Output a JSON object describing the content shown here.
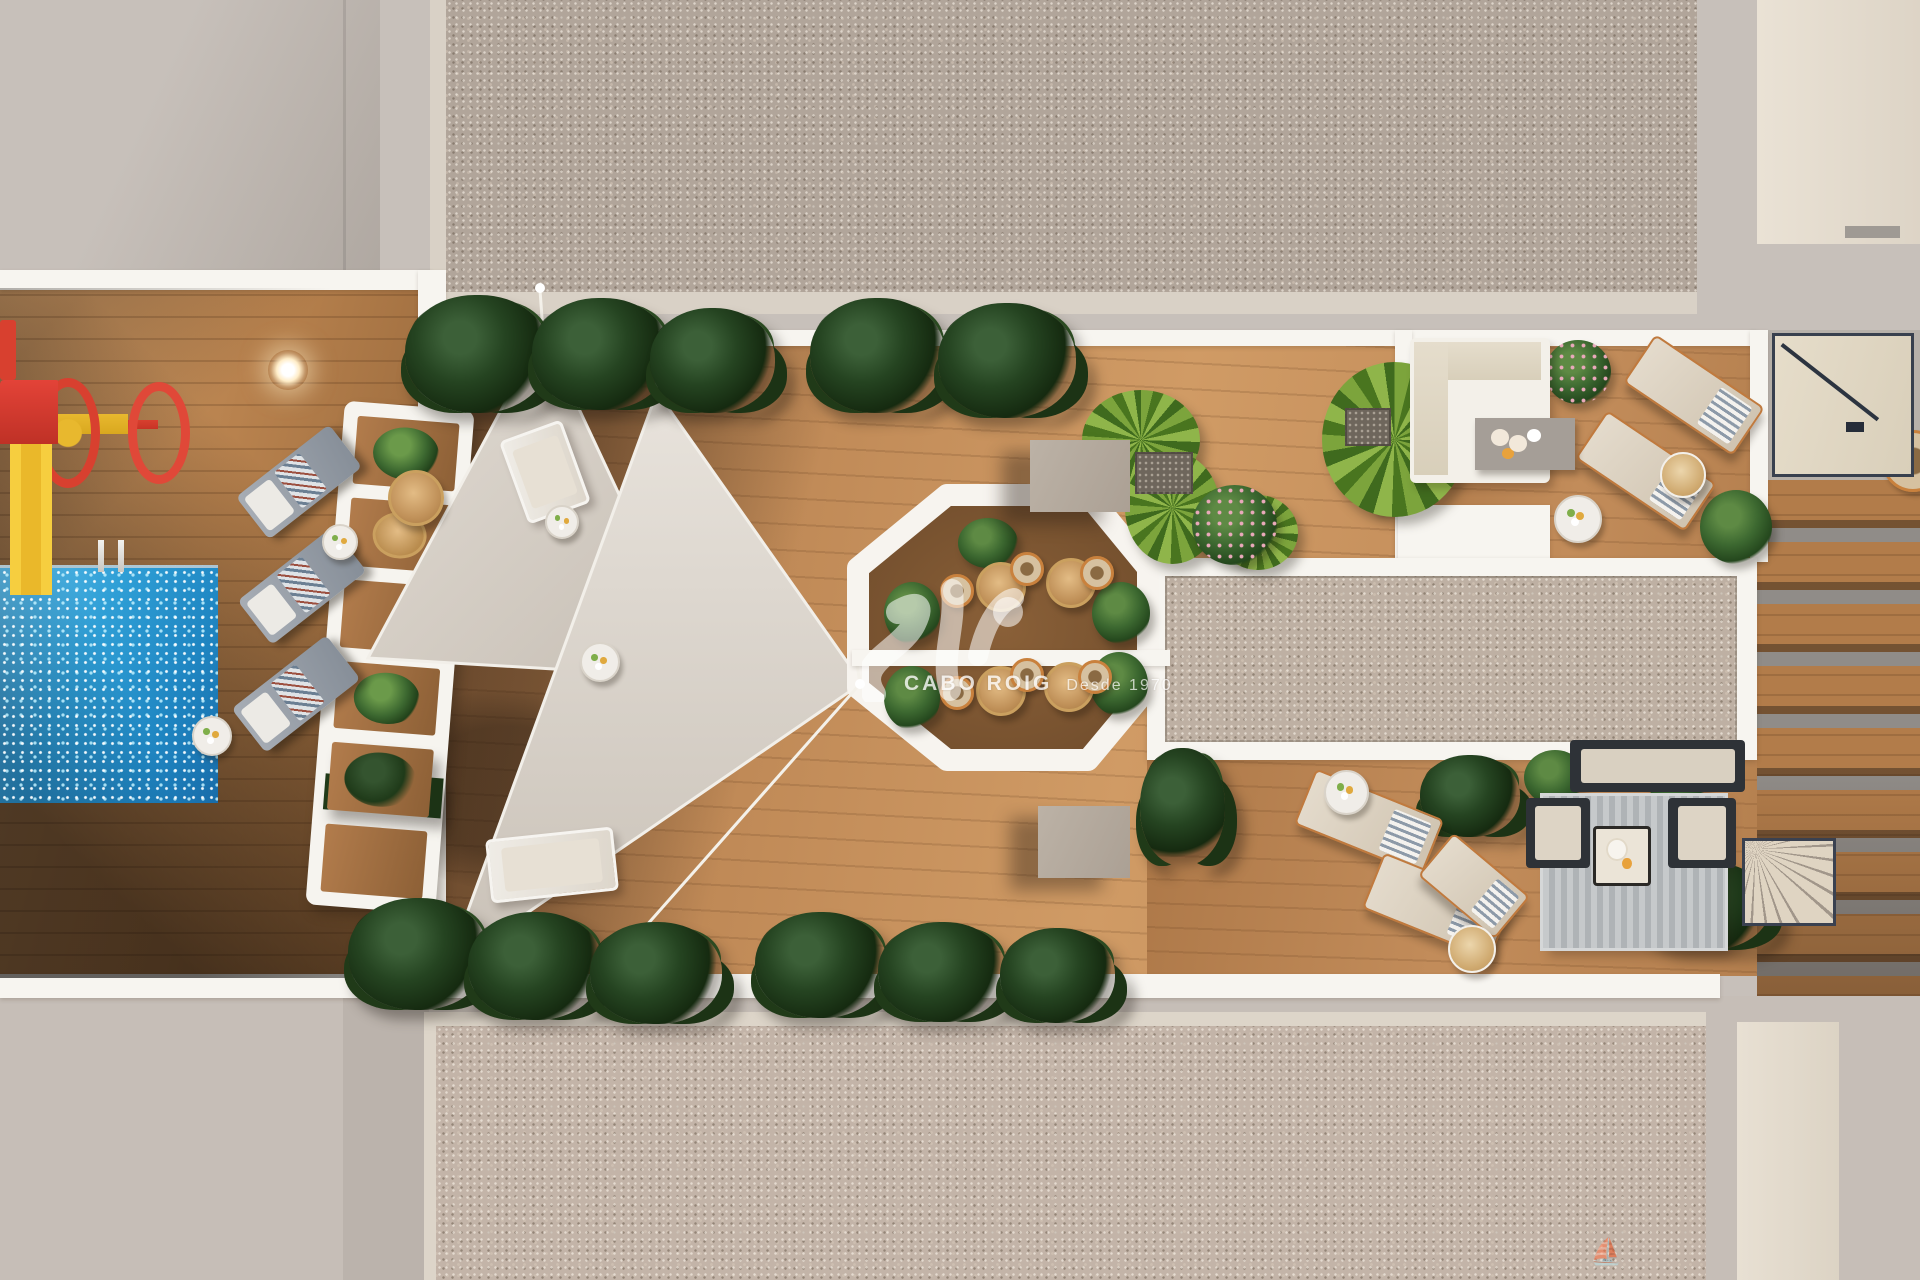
{
  "watermark": {
    "brand": "CABO ROIG",
    "since": "Desde 1970"
  },
  "palette": {
    "pavement": "#c7c0ba",
    "roof_speckle": "#b1a59a",
    "roof_speckle_bottom": "#c3b4a8",
    "carpet_speckle": "#beb0a3",
    "white_border": "#f7f5f0",
    "cream_edge": "#d9d1c6",
    "wood_lit": "#c08a58",
    "wood_shadow": "#8f6136",
    "octagon_wood": "#7d5634",
    "sail": "#d8d1c8",
    "pool_blue": "#2f9fd6",
    "plant_dark": "#254421",
    "plant_bright": "#7ca43c",
    "playground_red": "#d8402f",
    "playground_yellow": "#e8b82e",
    "copper_frame": "#c07a3e",
    "navy_frame": "#38404e",
    "taupe_block": "#b3a99e"
  },
  "scene": {
    "pergola_cells": [
      "plantS",
      "table",
      "wood",
      "plantS",
      "plantD",
      "wood"
    ],
    "items": [
      {
        "t": "plantD",
        "x": 405,
        "y": 295,
        "w": 145,
        "h": 118
      },
      {
        "t": "plantD",
        "x": 532,
        "y": 298,
        "w": 138,
        "h": 112
      },
      {
        "t": "plantD",
        "x": 650,
        "y": 308,
        "w": 125,
        "h": 105
      },
      {
        "t": "plantD",
        "x": 810,
        "y": 298,
        "w": 135,
        "h": 115
      },
      {
        "t": "plantD",
        "x": 938,
        "y": 303,
        "w": 138,
        "h": 115
      },
      {
        "t": "plantD",
        "x": 348,
        "y": 898,
        "w": 140,
        "h": 112
      },
      {
        "t": "plantD",
        "x": 468,
        "y": 912,
        "w": 135,
        "h": 108
      },
      {
        "t": "plantD",
        "x": 590,
        "y": 922,
        "w": 132,
        "h": 102
      },
      {
        "t": "plantD",
        "x": 755,
        "y": 912,
        "w": 132,
        "h": 106
      },
      {
        "t": "plantD",
        "x": 878,
        "y": 922,
        "w": 128,
        "h": 100
      },
      {
        "t": "plantD",
        "x": 1000,
        "y": 928,
        "w": 115,
        "h": 95
      },
      {
        "t": "plantD",
        "x": 1140,
        "y": 748,
        "w": 85,
        "h": 118
      },
      {
        "t": "plantD",
        "x": 1420,
        "y": 755,
        "w": 100,
        "h": 82
      },
      {
        "t": "plantD",
        "x": 1645,
        "y": 862,
        "w": 125,
        "h": 88
      },
      {
        "t": "plantY",
        "x": 1082,
        "y": 390,
        "w": 118,
        "h": 100
      },
      {
        "t": "plantY",
        "x": 1125,
        "y": 452,
        "w": 95,
        "h": 112
      },
      {
        "t": "plantY",
        "x": 1322,
        "y": 362,
        "w": 145,
        "h": 155
      },
      {
        "t": "plantY",
        "x": 1218,
        "y": 495,
        "w": 80,
        "h": 75
      },
      {
        "t": "bushP",
        "x": 1192,
        "y": 485,
        "w": 85,
        "h": 80
      },
      {
        "t": "bushP",
        "x": 1545,
        "y": 340,
        "w": 66,
        "h": 64
      },
      {
        "t": "bushG",
        "x": 1700,
        "y": 490,
        "w": 72,
        "h": 74
      },
      {
        "t": "bushG",
        "x": 958,
        "y": 518,
        "w": 60,
        "h": 50
      },
      {
        "t": "bushG",
        "x": 884,
        "y": 582,
        "w": 56,
        "h": 62
      },
      {
        "t": "bushG",
        "x": 884,
        "y": 666,
        "w": 56,
        "h": 64
      },
      {
        "t": "bushG",
        "x": 1092,
        "y": 582,
        "w": 58,
        "h": 62
      },
      {
        "t": "bushG",
        "x": 1090,
        "y": 652,
        "w": 58,
        "h": 64
      },
      {
        "t": "bushG",
        "x": 1524,
        "y": 750,
        "w": 62,
        "h": 55
      },
      {
        "t": "bushG",
        "x": 1646,
        "y": 750,
        "w": 64,
        "h": 56
      },
      {
        "t": "loungerG",
        "x": 240,
        "y": 455,
        "w": 118,
        "h": 54,
        "r": -38
      },
      {
        "t": "loungerG",
        "x": 242,
        "y": 558,
        "w": 120,
        "h": 56,
        "r": -38
      },
      {
        "t": "loungerG",
        "x": 236,
        "y": 666,
        "w": 120,
        "h": 56,
        "r": -38
      },
      {
        "t": "loungerW",
        "x": 512,
        "y": 428,
        "w": 66,
        "h": 88,
        "r": -20
      },
      {
        "t": "loungerW",
        "x": 488,
        "y": 833,
        "w": 128,
        "h": 64,
        "r": -6
      },
      {
        "t": "loungerB",
        "x": 1628,
        "y": 366,
        "w": 132,
        "h": 58,
        "r": 34
      },
      {
        "t": "loungerB",
        "x": 1580,
        "y": 442,
        "w": 132,
        "h": 58,
        "r": 34
      },
      {
        "t": "loungerB",
        "x": 1300,
        "y": 792,
        "w": 138,
        "h": 60,
        "r": 22
      },
      {
        "t": "loungerB",
        "x": 1368,
        "y": 876,
        "w": 138,
        "h": 60,
        "r": 22
      },
      {
        "t": "loungerB",
        "x": 1424,
        "y": 858,
        "w": 100,
        "h": 56,
        "r": 40
      },
      {
        "t": "tableS",
        "x": 322,
        "y": 524,
        "w": 36,
        "h": 36
      },
      {
        "t": "tableS",
        "x": 192,
        "y": 716,
        "w": 40,
        "h": 40
      },
      {
        "t": "tableS",
        "x": 545,
        "y": 505,
        "w": 34,
        "h": 34
      },
      {
        "t": "tableS",
        "x": 580,
        "y": 642,
        "w": 40,
        "h": 40
      },
      {
        "t": "tableS",
        "x": 1324,
        "y": 770,
        "w": 45,
        "h": 45
      },
      {
        "t": "tableS",
        "x": 1554,
        "y": 495,
        "w": 48,
        "h": 48
      },
      {
        "t": "tableW",
        "x": 1660,
        "y": 452,
        "w": 46,
        "h": 46
      },
      {
        "t": "tableW",
        "x": 1448,
        "y": 925,
        "w": 48,
        "h": 48
      },
      {
        "t": "tableR",
        "x": 388,
        "y": 470,
        "w": 56,
        "h": 56
      },
      {
        "t": "tableR",
        "x": 976,
        "y": 562,
        "w": 50,
        "h": 50
      },
      {
        "t": "tableR",
        "x": 1046,
        "y": 558,
        "w": 50,
        "h": 50
      },
      {
        "t": "tableR",
        "x": 976,
        "y": 666,
        "w": 50,
        "h": 50
      },
      {
        "t": "tableR",
        "x": 1044,
        "y": 662,
        "w": 50,
        "h": 50
      },
      {
        "t": "chairO",
        "x": 940,
        "y": 574,
        "w": 34,
        "h": 34
      },
      {
        "t": "chairO",
        "x": 1010,
        "y": 552,
        "w": 34,
        "h": 34
      },
      {
        "t": "chairO",
        "x": 1080,
        "y": 556,
        "w": 34,
        "h": 34
      },
      {
        "t": "chairO",
        "x": 940,
        "y": 676,
        "w": 34,
        "h": 34
      },
      {
        "t": "chairO",
        "x": 1010,
        "y": 658,
        "w": 34,
        "h": 34
      },
      {
        "t": "chairO",
        "x": 1078,
        "y": 660,
        "w": 34,
        "h": 34
      },
      {
        "t": "chairO",
        "x": 1882,
        "y": 430,
        "w": 62,
        "h": 62
      },
      {
        "t": "sqT",
        "x": 1030,
        "y": 440,
        "w": 100,
        "h": 72
      },
      {
        "t": "sqT",
        "x": 1038,
        "y": 806,
        "w": 92,
        "h": 72
      },
      {
        "t": "planter",
        "x": 1135,
        "y": 452,
        "w": 58,
        "h": 42
      },
      {
        "t": "planter",
        "x": 1345,
        "y": 408,
        "w": 46,
        "h": 38
      },
      {
        "t": "lamp",
        "x": 268,
        "y": 350,
        "w": 40,
        "h": 40
      },
      {
        "t": "roller",
        "x": 0,
        "y": 376,
        "w": 180,
        "h": 100
      },
      {
        "t": "slide",
        "x": 0,
        "y": 380,
        "w": 60,
        "h": 215
      },
      {
        "t": "redbit",
        "x": 0,
        "y": 320,
        "w": 16,
        "h": 60
      },
      {
        "t": "ladder",
        "x": 92,
        "y": 540,
        "w": 40,
        "h": 32
      },
      {
        "t": "rugS",
        "x": 1543,
        "y": 796,
        "w": 182,
        "h": 152
      },
      {
        "t": "armN",
        "x": 1526,
        "y": 798,
        "w": 64,
        "h": 70
      },
      {
        "t": "armN",
        "x": 1668,
        "y": 798,
        "w": 68,
        "h": 70
      },
      {
        "t": "sofaN",
        "x": 1570,
        "y": 740,
        "w": 175,
        "h": 52
      },
      {
        "t": "tabC",
        "x": 1593,
        "y": 826,
        "w": 58,
        "h": 60
      },
      {
        "t": "sofaL",
        "x": 1410,
        "y": 338,
        "w": 140,
        "h": 145
      },
      {
        "t": "tableG",
        "x": 1475,
        "y": 418,
        "w": 100,
        "h": 52
      },
      {
        "t": "fan",
        "x": 1742,
        "y": 838,
        "w": 94,
        "h": 88
      },
      {
        "t": "stair",
        "x": 1775,
        "y": 336,
        "w": 136,
        "h": 138
      },
      {
        "t": "boat",
        "x": 1590,
        "y": 1236,
        "w": 22,
        "h": 30
      }
    ]
  }
}
